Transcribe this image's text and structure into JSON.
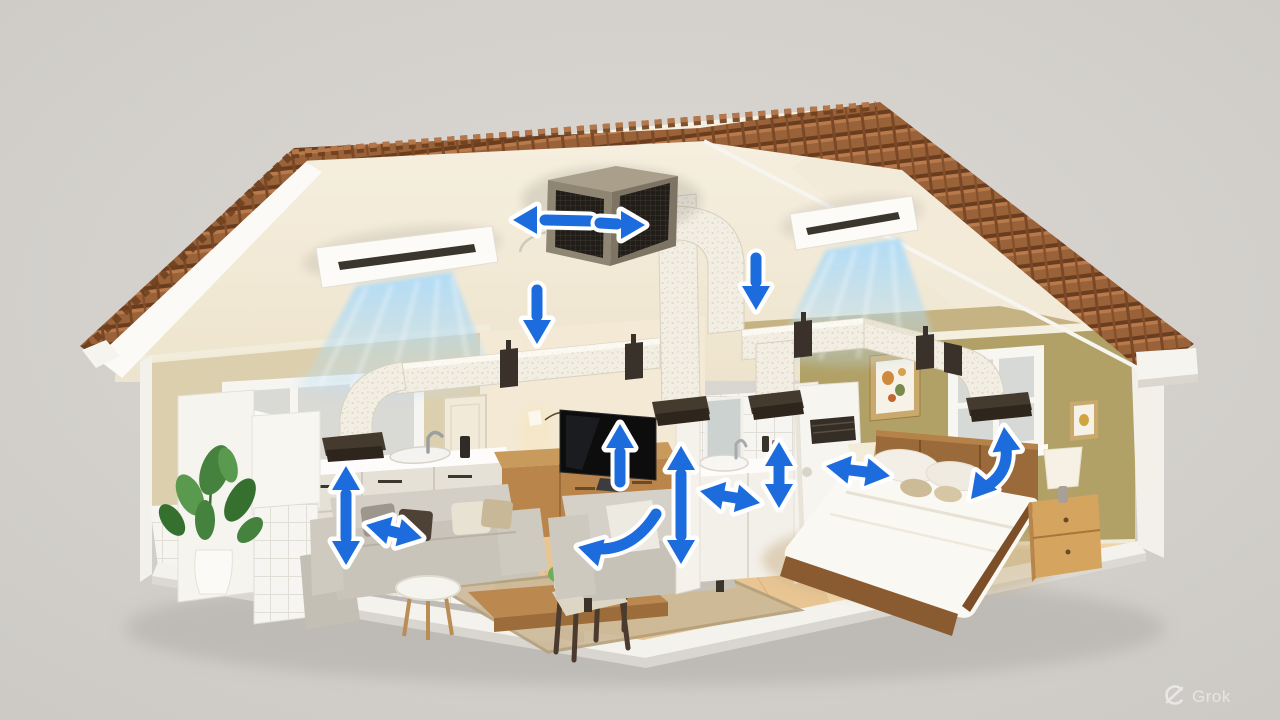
{
  "watermark": {
    "logo_icon": "grok-circle-logo",
    "label": "Grok"
  },
  "scene": {
    "type": "3d-cutaway-illustration",
    "subject": "Whole-house ducted HVAC airflow diagram inside a cutaway single-story house",
    "background_color": "#d6d3cf",
    "airflow_arrow_color": "#1d6cdd",
    "airflow_arrow_outline": "#ffffff",
    "air_stream_color": "#a8d8f4",
    "roof": {
      "covering": "terracotta tiles",
      "tile_color": "#9a6238",
      "fascia_color": "#fbfaf7",
      "style": "cutaway gable with exposed cream interior"
    },
    "attic": {
      "interior_color": "#f3ebdb",
      "equipment": [
        "central HVAC unit",
        "left ceiling cassette AC",
        "right ceiling cassette AC"
      ],
      "hvac_unit_grille_color": "#26211c",
      "hvac_unit_frame_color": "#8f8573"
    },
    "ducts": {
      "color": "#f2eee4",
      "insulated": true,
      "hanger_strap_color": "#3a312a",
      "register_color": "#453a2e",
      "registers": [
        "kitchen",
        "hall-left",
        "hall-right",
        "bedroom-above-window"
      ]
    },
    "rooms": [
      {
        "name": "kitchen",
        "wall_color": "#dccfad",
        "floor": "white ceramic tile",
        "contents": [
          "window",
          "potted plant",
          "range-hood column",
          "sink with faucet",
          "drawer cabinets",
          "counter"
        ]
      },
      {
        "name": "living-room",
        "wall_color": "#f3e9d5",
        "floor": "light oak",
        "contents": [
          "interior door",
          "wall sconce",
          "flat-screen TV",
          "wood media console",
          "gray sofa with pillows",
          "gray loveseat",
          "round side table",
          "wood coffee table with decor",
          "dark dining chair",
          "beige area rug"
        ]
      },
      {
        "name": "bathroom",
        "wall_color": "white tile",
        "contents": [
          "mirror",
          "vanity with sink and faucet",
          "toiletry bottles"
        ]
      },
      {
        "name": "bedroom",
        "wall_color": "#b1a167",
        "floor": "light oak with beige rug",
        "contents": [
          "window",
          "framed botanical print",
          "small framed print",
          "tall white air-handler cabinet with vent",
          "double bed with white duvet",
          "wood headboard",
          "pillows",
          "nightstand with lamp",
          "two-drawer nightstand with lamp"
        ]
      }
    ],
    "airflow_arrows": [
      {
        "id": "hvac-out-left",
        "direction": "left",
        "location": "attic, left side of HVAC unit"
      },
      {
        "id": "hvac-out-right",
        "direction": "right",
        "location": "attic, front grille of HVAC unit"
      },
      {
        "id": "supply-down-left",
        "direction": "down",
        "location": "over living-room wall top"
      },
      {
        "id": "supply-down-right",
        "direction": "down",
        "location": "below right cassette, over bedroom wall"
      },
      {
        "id": "kitchen-circulation",
        "direction": "up-down",
        "location": "kitchen, under duct register"
      },
      {
        "id": "sofa-circulation",
        "direction": "left-right",
        "location": "above left sofa"
      },
      {
        "id": "tv-up",
        "direction": "up",
        "location": "in front of TV"
      },
      {
        "id": "living-room-curve",
        "direction": "curved-down-left",
        "location": "over loveseat"
      },
      {
        "id": "living-bath-circulation",
        "direction": "up-down",
        "location": "between living room and bathroom"
      },
      {
        "id": "bathroom-circulation",
        "direction": "left-right",
        "location": "over bathroom vanity"
      },
      {
        "id": "bathroom-vertical",
        "direction": "up-down",
        "location": "right of bathroom mirror"
      },
      {
        "id": "bedroom-circulation",
        "direction": "left-right",
        "location": "between air-handler cabinet and bed"
      },
      {
        "id": "bedroom-curve",
        "direction": "curved-up",
        "location": "from bed to register above window"
      }
    ]
  }
}
